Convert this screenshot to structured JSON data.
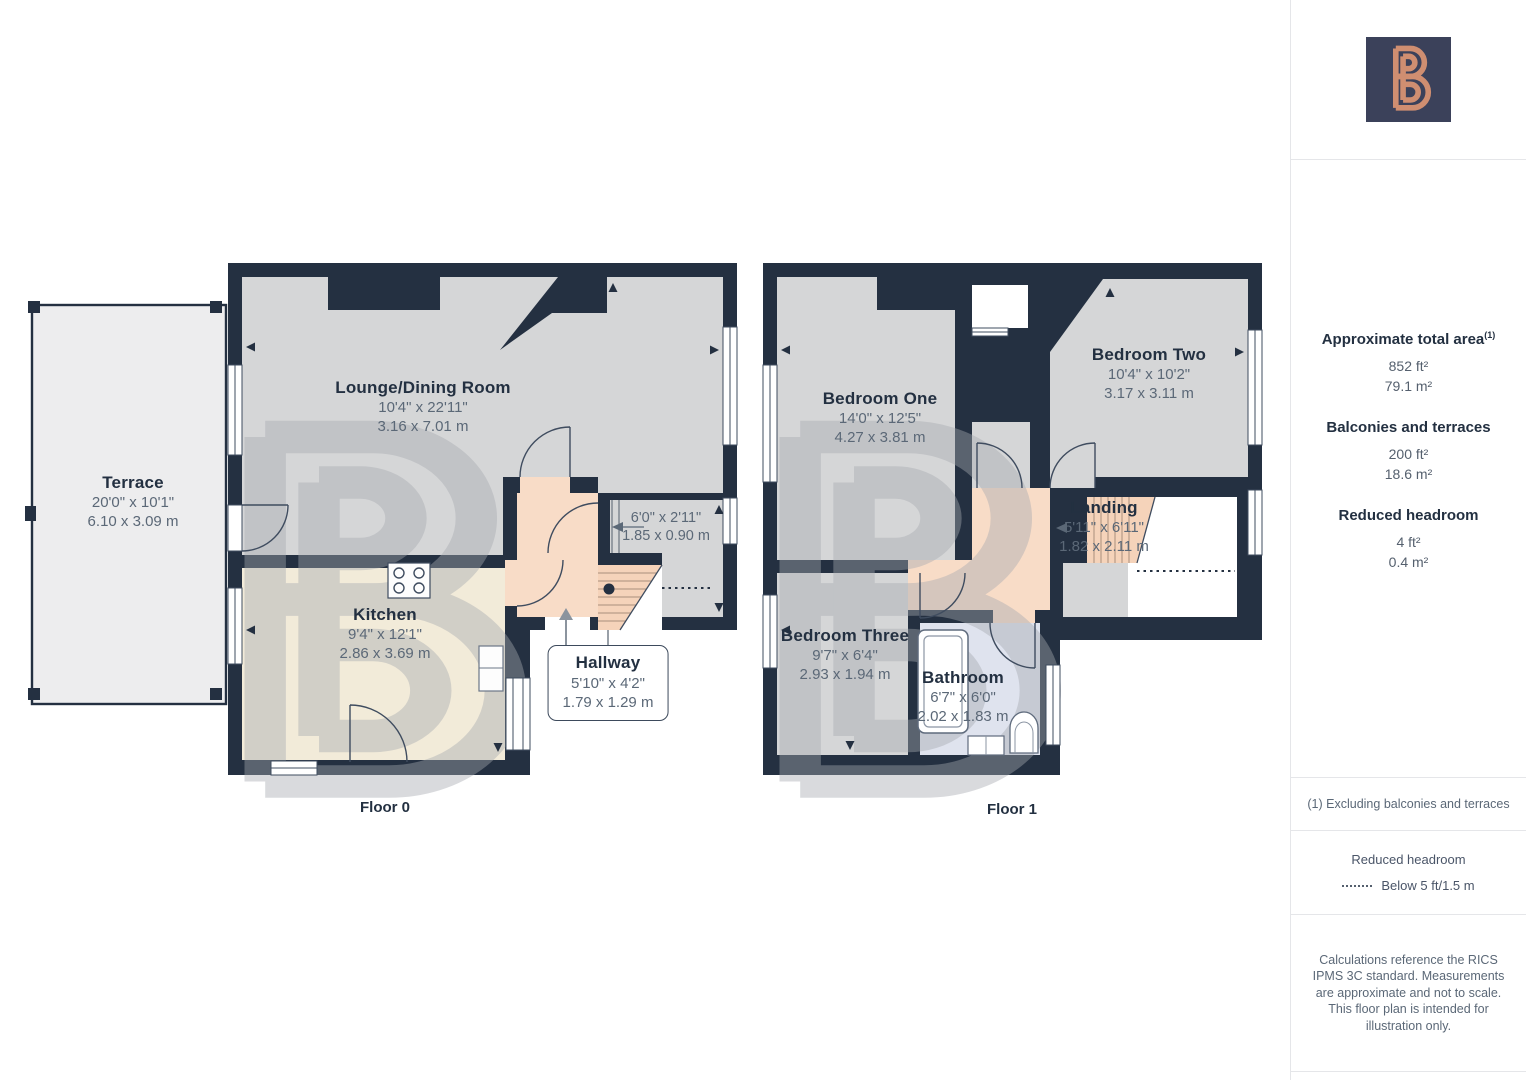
{
  "floor0": {
    "label": "Floor 0",
    "rooms": [
      {
        "name": "Terrace",
        "dim_ft": "20'0\" x 10'1\"",
        "dim_m": "6.10 x 3.09 m"
      },
      {
        "name": "Lounge/Dining Room",
        "dim_ft": "10'4\" x 22'11\"",
        "dim_m": "3.16 x 7.01 m"
      },
      {
        "name": "Kitchen",
        "dim_ft": "9'4\" x 12'1\"",
        "dim_m": "2.86 x 3.69 m"
      },
      {
        "name": "Hallway",
        "dim_ft": "5'10\" x 4'2\"",
        "dim_m": "1.79 x 1.29 m"
      }
    ],
    "corridor": {
      "dim_ft": "6'0\" x 2'11\"",
      "dim_m": "1.85 x 0.90 m"
    }
  },
  "floor1": {
    "label": "Floor 1",
    "rooms": [
      {
        "name": "Bedroom One",
        "dim_ft": "14'0\" x 12'5\"",
        "dim_m": "4.27 x 3.81 m"
      },
      {
        "name": "Bedroom Two",
        "dim_ft": "10'4\" x 10'2\"",
        "dim_m": "3.17 x 3.11 m"
      },
      {
        "name": "Landing",
        "dim_ft": "5'11\" x 6'11\"",
        "dim_m": "1.82 x 2.11 m"
      },
      {
        "name": "Bedroom Three",
        "dim_ft": "9'7\" x 6'4\"",
        "dim_m": "2.93 x 1.94 m"
      },
      {
        "name": "Bathroom",
        "dim_ft": "6'7\" x 6'0\"",
        "dim_m": "2.02 x 1.83 m"
      }
    ]
  },
  "sidebar": {
    "total_area": {
      "title": "Approximate total area",
      "footnote_mark": "(1)",
      "ft": "852 ft²",
      "m": "79.1 m²"
    },
    "balconies": {
      "title": "Balconies and terraces",
      "ft": "200 ft²",
      "m": "18.6 m²"
    },
    "reduced": {
      "title": "Reduced headroom",
      "ft": "4 ft²",
      "m": "0.4 m²"
    },
    "footnote": "(1) Excluding balconies and terraces",
    "legend": {
      "title": "Reduced headroom",
      "item": "Below 5 ft/1.5 m"
    },
    "disclaimer": "Calculations reference the RICS IPMS 3C standard. Measurements are approximate and not to scale. This floor plan is intended for illustration only."
  },
  "colors": {
    "wall": "#243041",
    "room_gray": "#d5d6d7",
    "kitchen_cream": "#f2ebd9",
    "hall_peach": "#f8dcc7",
    "stair_peach": "#f5d3ba",
    "bathroom_blue": "#dfe3ee",
    "terrace_gray": "#ededee",
    "logo_bg": "#3b415a",
    "logo_stroke": "#cf8e71",
    "text_dark": "#233041",
    "text_dim": "#5b6877"
  }
}
